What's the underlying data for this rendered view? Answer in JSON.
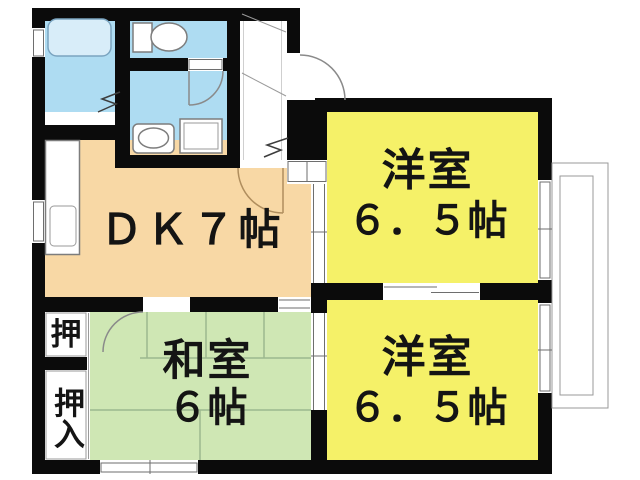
{
  "floorplan": {
    "rooms": {
      "dk": {
        "label": "ＤＫ７帖"
      },
      "western_top": {
        "name": "洋室",
        "size": "６．５帖"
      },
      "western_bottom": {
        "name": "洋室",
        "size": "６．５帖"
      },
      "japanese": {
        "name": "和室",
        "size": "６帖"
      },
      "closet_upper": {
        "label": "押"
      },
      "closet_lower": {
        "label": "押入"
      }
    },
    "fixtures": [
      "bathtub",
      "toilet",
      "vanity-sink",
      "washing-machine-pan",
      "kitchen-counter",
      "kitchen-sink",
      "balcony"
    ],
    "colors": {
      "wall": "#0b0b0b",
      "dk": "#f8d8a5",
      "western": "#f5f168",
      "japanese": "#cfe7b4",
      "wet": "#aedcf2",
      "tub": "#d8edf9",
      "text": "#141414",
      "line": "#999999",
      "tatami": "#9cb88e"
    }
  }
}
